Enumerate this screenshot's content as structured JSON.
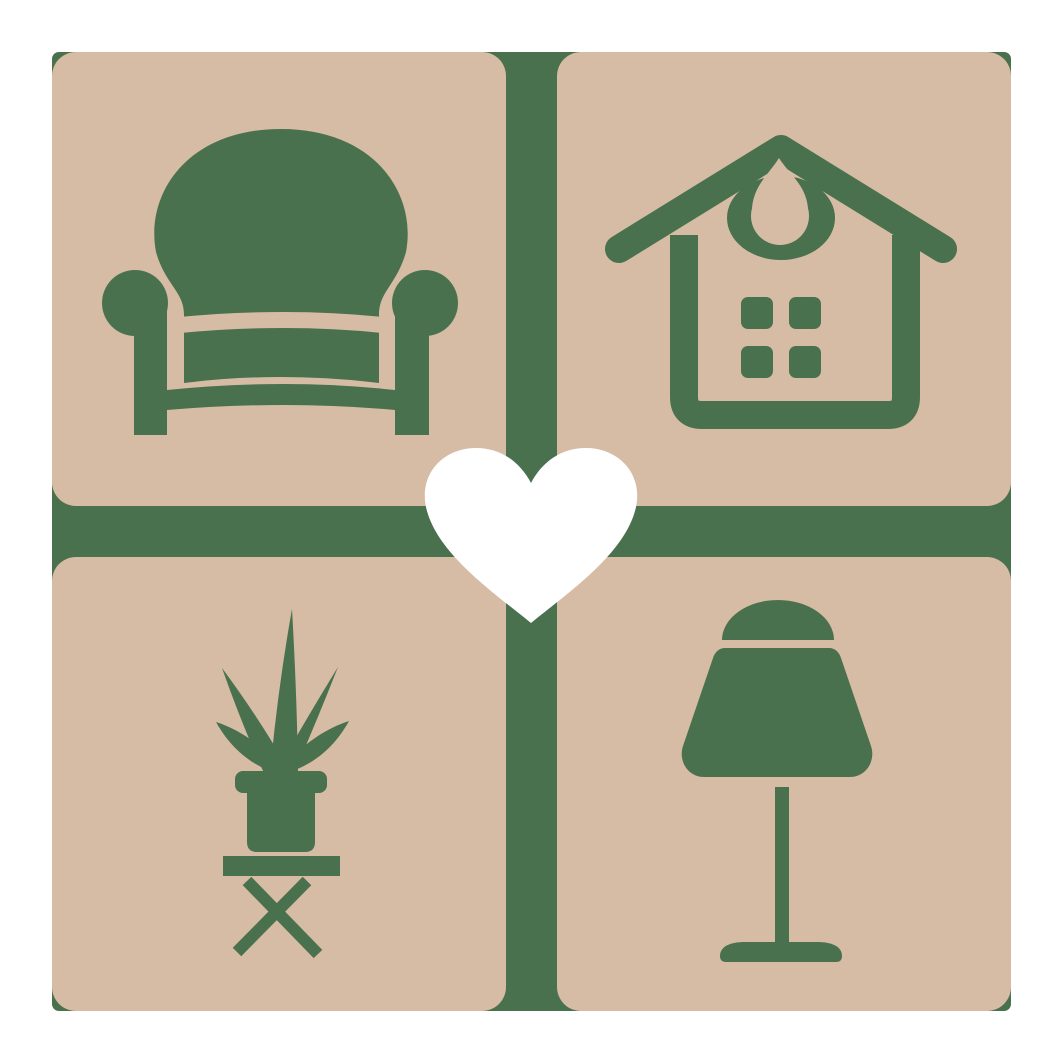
{
  "logo": {
    "colors": {
      "background": "#ffffff",
      "tile": "#d6bca4",
      "icon": "#4a714e",
      "heart": "#ffffff"
    },
    "tiles": [
      {
        "position": "top-left",
        "icon": "armchair-icon",
        "label": "armchair"
      },
      {
        "position": "top-right",
        "icon": "house-icon",
        "label": "house"
      },
      {
        "position": "bottom-left",
        "icon": "potted-plant-icon",
        "label": "potted plant on stool"
      },
      {
        "position": "bottom-right",
        "icon": "table-lamp-icon",
        "label": "table lamp"
      }
    ],
    "center": {
      "icon": "heart-icon",
      "label": "heart"
    }
  }
}
